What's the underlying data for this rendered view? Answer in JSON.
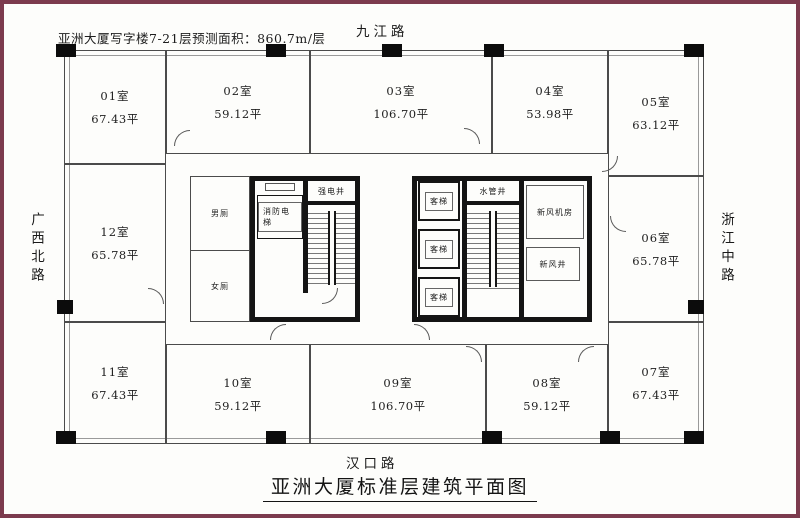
{
  "frame": {
    "color": "#7c3b4e"
  },
  "note": "亚洲大厦写字楼7-21层预测面积：860.7m/层",
  "title": "亚洲大厦标准层建筑平面图",
  "roads": {
    "north": "九江路",
    "south": "汉口路",
    "west": "广西北路",
    "east": "浙江中路"
  },
  "rooms": [
    {
      "num": "01室",
      "area": "67.43平"
    },
    {
      "num": "02室",
      "area": "59.12平"
    },
    {
      "num": "03室",
      "area": "106.70平"
    },
    {
      "num": "04室",
      "area": "53.98平"
    },
    {
      "num": "05室",
      "area": "63.12平"
    },
    {
      "num": "06室",
      "area": "65.78平"
    },
    {
      "num": "07室",
      "area": "67.43平"
    },
    {
      "num": "08室",
      "area": "59.12平"
    },
    {
      "num": "09室",
      "area": "106.70平"
    },
    {
      "num": "10室",
      "area": "59.12平"
    },
    {
      "num": "11室",
      "area": "67.43平"
    },
    {
      "num": "12室",
      "area": "65.78平"
    }
  ],
  "core": {
    "mens_toilet": "男厕",
    "womens_toilet": "女厕",
    "fire_elevator": "消防电梯",
    "strong_electric_shaft": "强电井",
    "passenger_elevator": "客梯",
    "water_pipe_shaft": "水管井",
    "fresh_air_plant_room": "新风机房",
    "fresh_air_shaft": "新风井"
  }
}
